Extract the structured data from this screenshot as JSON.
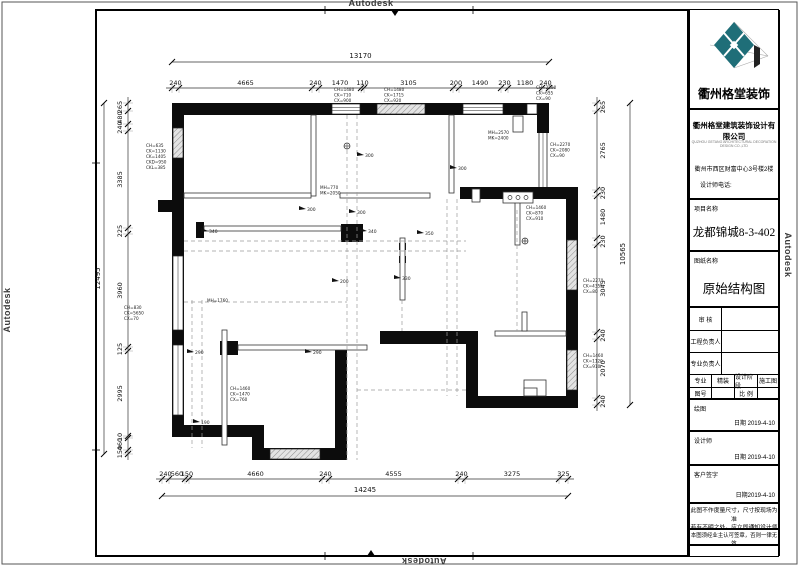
{
  "sheet": {
    "watermark": "Autodesk"
  },
  "title_block": {
    "brand": "衢州格堂装饰",
    "company": "衢州格堂建筑装饰设计有限公司",
    "company_en": "QUZHOU GETANG ARCHITECTURAL DECORATION DESIGN CO.,LTD",
    "address": "衢州市西区财富中心3号楼2楼",
    "phone_label": "设计师电话:",
    "project_label": "项目名称",
    "project_name": "龙都锦城8-3-402",
    "drawing_label": "图纸名称",
    "drawing_name": "原始结构图",
    "review_label": "审  核",
    "pm_label": "工程负责人",
    "lead_label": "专业负责人",
    "major_label": "专业",
    "major_value": "精装",
    "stage_label": "设计阶段",
    "stage_value": "施工图",
    "no_label": "图号",
    "scale_label": "比  例",
    "draw_label": "绘图",
    "draw_date": "日期 2019-4-10",
    "designer_label": "设计师",
    "designer_date": "日期 2019-4-10",
    "client_label": "客户签字",
    "client_date": "日期2019-4-10",
    "note1a": "此图不作度量尺寸，尺寸按现场为准",
    "note1b": "若有不明之处，应立即通知设计师",
    "note2": "本图须经业主认可签章，否则一律无效"
  },
  "plan": {
    "dims": {
      "top": {
        "total": "13170",
        "segments": [
          "240",
          "4665",
          "240",
          "1470",
          "110",
          "3105",
          "200",
          "1490",
          "230",
          "1180",
          "240"
        ]
      },
      "bottom": {
        "total": "14245",
        "segments": [
          "240",
          "560",
          "150",
          "4660",
          "240",
          "4555",
          "240",
          "3275",
          "325"
        ]
      },
      "left": {
        "total": "12495",
        "segments": [
          "265",
          "480",
          "240",
          "3385",
          "225",
          "3960",
          "125",
          "2995",
          "10",
          "460",
          "150"
        ]
      },
      "right": {
        "total": "10565",
        "segments": [
          "265",
          "2765",
          "230",
          "1480",
          "230",
          "3045",
          "240",
          "2070",
          "240"
        ]
      }
    },
    "annotations": [
      {
        "x": 334,
        "y": 91,
        "lines": [
          "CH=1480",
          "CK=710",
          "CX=900"
        ]
      },
      {
        "x": 384,
        "y": 91,
        "lines": [
          "CH=1480",
          "CK=1715",
          "CX=920"
        ]
      },
      {
        "x": 536,
        "y": 89,
        "lines": [
          "CH=2290",
          "CK=655",
          "CX=90"
        ]
      },
      {
        "x": 146,
        "y": 147,
        "lines": [
          "CH=635",
          "CK=1130",
          "CK=1405",
          "CKD=950",
          "CKL=385"
        ]
      },
      {
        "x": 124,
        "y": 309,
        "lines": [
          "CH=830",
          "CK=5650",
          "CX=70"
        ]
      },
      {
        "x": 550,
        "y": 146,
        "lines": [
          "CH=2270",
          "CK=2080",
          "CX=90"
        ]
      },
      {
        "x": 526,
        "y": 209,
        "lines": [
          "CH=1460",
          "CK=870",
          "CX=910"
        ]
      },
      {
        "x": 583,
        "y": 282,
        "lines": [
          "CH=2270",
          "CK=4355",
          "CX=80"
        ]
      },
      {
        "x": 583,
        "y": 357,
        "lines": [
          "CH=1460",
          "CK=1120",
          "CX=910"
        ]
      },
      {
        "x": 230,
        "y": 390,
        "lines": [
          "CH=1460",
          "CK=1470",
          "CX=760"
        ]
      },
      {
        "x": 320,
        "y": 189,
        "lines": [
          "MH=770",
          "MK=2050"
        ]
      },
      {
        "x": 488,
        "y": 134,
        "lines": [
          "MH=2570",
          "MK=2400"
        ]
      },
      {
        "x": 207,
        "y": 302,
        "lines": [
          "MH=1760"
        ]
      }
    ],
    "beams": [
      {
        "x": 307,
        "y": 209,
        "label": "300"
      },
      {
        "x": 357,
        "y": 212,
        "label": "300"
      },
      {
        "x": 365,
        "y": 155,
        "label": "300"
      },
      {
        "x": 458,
        "y": 168,
        "label": "300"
      },
      {
        "x": 209,
        "y": 231,
        "label": "340"
      },
      {
        "x": 368,
        "y": 231,
        "label": "340"
      },
      {
        "x": 425,
        "y": 233,
        "label": "350"
      },
      {
        "x": 402,
        "y": 278,
        "label": "330"
      },
      {
        "x": 340,
        "y": 281,
        "label": "200"
      },
      {
        "x": 195,
        "y": 352,
        "label": "290"
      },
      {
        "x": 313,
        "y": 352,
        "label": "290"
      },
      {
        "x": 201,
        "y": 422,
        "label": "190"
      }
    ]
  }
}
